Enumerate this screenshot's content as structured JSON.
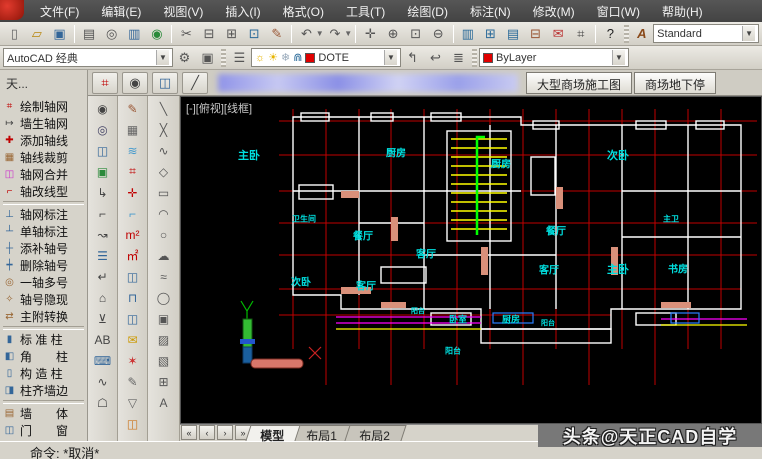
{
  "colors": {
    "canvas_bg": "#000000",
    "axis_red": "#c00000",
    "room_label_cyan": "#00e0e0",
    "stair_yellow": "#ffff00",
    "stair_green": "#00ff00",
    "balcony_magenta": "#ff00ff",
    "wall_white": "#ffffff",
    "layer_swatch_red": "#e00000"
  },
  "menu": {
    "items": [
      {
        "label": "文件(F)"
      },
      {
        "label": "编辑(E)"
      },
      {
        "label": "视图(V)"
      },
      {
        "label": "插入(I)"
      },
      {
        "label": "格式(O)"
      },
      {
        "label": "工具(T)"
      },
      {
        "label": "绘图(D)"
      },
      {
        "label": "标注(N)"
      },
      {
        "label": "修改(M)"
      },
      {
        "label": "窗口(W)"
      },
      {
        "label": "帮助(H)"
      }
    ]
  },
  "toolbar1": {
    "icons": [
      {
        "name": "new-file-icon",
        "glyph": "▯",
        "color": "#666"
      },
      {
        "name": "open-file-icon",
        "glyph": "▱",
        "color": "#b8860b"
      },
      {
        "name": "save-icon",
        "glyph": "▣",
        "color": "#336699"
      },
      {
        "sep": true
      },
      {
        "name": "print-icon",
        "glyph": "▤",
        "color": "#555"
      },
      {
        "name": "print-preview-icon",
        "glyph": "◎",
        "color": "#555"
      },
      {
        "name": "eplot-icon",
        "glyph": "▥",
        "color": "#336699"
      },
      {
        "name": "publish-icon",
        "glyph": "◉",
        "color": "#2a8a3a"
      },
      {
        "sep": true
      },
      {
        "name": "cut-icon",
        "glyph": "✂",
        "color": "#555"
      },
      {
        "name": "copy-icon",
        "glyph": "⊟",
        "color": "#555"
      },
      {
        "name": "paste-icon",
        "glyph": "⊞",
        "color": "#555"
      },
      {
        "name": "paste-as-block-icon",
        "glyph": "⊡",
        "color": "#2a6a99"
      },
      {
        "name": "match-properties-icon",
        "glyph": "✎",
        "color": "#995533"
      },
      {
        "sep": true
      },
      {
        "name": "undo-icon",
        "glyph": "↶",
        "color": "#555",
        "caret": true
      },
      {
        "name": "redo-icon",
        "glyph": "↷",
        "color": "#555",
        "caret": true
      },
      {
        "sep": true
      },
      {
        "name": "pan-icon",
        "glyph": "✛",
        "color": "#555"
      },
      {
        "name": "zoom-realtime-icon",
        "glyph": "⊕",
        "color": "#555"
      },
      {
        "name": "zoom-window-icon",
        "glyph": "⊡",
        "color": "#555"
      },
      {
        "name": "zoom-previous-icon",
        "glyph": "⊖",
        "color": "#555"
      },
      {
        "sep": true
      },
      {
        "name": "properties-icon",
        "glyph": "▥",
        "color": "#2a6a99"
      },
      {
        "name": "designcenter-icon",
        "glyph": "⊞",
        "color": "#2a6a99"
      },
      {
        "name": "tool-palettes-icon",
        "glyph": "▤",
        "color": "#2a6a99"
      },
      {
        "name": "sheetset-manager-icon",
        "glyph": "⊟",
        "color": "#995533"
      },
      {
        "name": "markup-set-icon",
        "glyph": "✉",
        "color": "#bb3333"
      },
      {
        "name": "quickcalc-icon",
        "glyph": "⌗",
        "color": "#444"
      },
      {
        "sep": true
      },
      {
        "name": "help-icon",
        "glyph": "?",
        "color": "#222"
      }
    ],
    "textstyle_icon_label": "A",
    "style_combo_value": "Standard"
  },
  "toolbar2": {
    "workspace_combo_value": "AutoCAD 经典",
    "gear_icon": "⚙",
    "workspace_settings_icon": "▣",
    "layer_properties_icon": "☰",
    "layer_combo": {
      "bulb_icon": "☼",
      "sun_icon": "☀",
      "freeze_icon": "❄",
      "lock_icon": "⋒",
      "layer_name": "DOTE"
    },
    "make_object_layer_icon": "↰",
    "layer_previous_icon": "↩",
    "layer_states_icon": "≣",
    "color_combo_value": "ByLayer"
  },
  "row3": {
    "palette_caption": "天...",
    "mini_toolbar": [
      {
        "name": "axis-grid-icon",
        "glyph": "⌗",
        "color": "#c00000"
      },
      {
        "name": "camera-icon",
        "glyph": "◉",
        "color": "#444"
      },
      {
        "name": "column-tool-icon",
        "glyph": "◫",
        "color": "#336699"
      },
      {
        "name": "draw-line-icon",
        "glyph": "╱",
        "color": "#444"
      }
    ],
    "doc_tabs": [
      {
        "label": "大型商场施工图"
      },
      {
        "label": "商场地下停"
      }
    ]
  },
  "sidebar": {
    "items": [
      {
        "label": "绘制轴网",
        "glyph": "⌗",
        "color": "#c00000"
      },
      {
        "label": "墙生轴网",
        "glyph": "↦",
        "color": "#444444"
      },
      {
        "label": "添加轴线",
        "glyph": "✚",
        "color": "#c00000"
      },
      {
        "label": "轴线裁剪",
        "glyph": "▦",
        "color": "#996633"
      },
      {
        "label": "轴网合并",
        "glyph": "◫",
        "color": "#cc33cc"
      },
      {
        "label": "轴改线型",
        "glyph": "⌐",
        "color": "#c00000"
      },
      {
        "label": "轴网标注",
        "glyph": "⊥",
        "color": "#336699",
        "sep_before": true
      },
      {
        "label": "单轴标注",
        "glyph": "┴",
        "color": "#336699"
      },
      {
        "label": "添补轴号",
        "glyph": "┼",
        "color": "#336699"
      },
      {
        "label": "删除轴号",
        "glyph": "┿",
        "color": "#336699"
      },
      {
        "label": "一轴多号",
        "glyph": "◎",
        "color": "#996633"
      },
      {
        "label": "轴号隐现",
        "glyph": "✧",
        "color": "#996633"
      },
      {
        "label": "主附转换",
        "glyph": "⇄",
        "color": "#996633"
      },
      {
        "label": "标 准 柱",
        "glyph": "▮",
        "color": "#336699",
        "sep_before": true
      },
      {
        "label": "角　　柱",
        "glyph": "◧",
        "color": "#336699"
      },
      {
        "label": "构 造 柱",
        "glyph": "▯",
        "color": "#336699"
      },
      {
        "label": "柱齐墙边",
        "glyph": "◨",
        "color": "#336699"
      },
      {
        "label": "墙　　体",
        "glyph": "▤",
        "color": "#996633",
        "sep_before": true
      },
      {
        "label": "门　　窗",
        "glyph": "◫",
        "color": "#336699"
      }
    ]
  },
  "toolcols": {
    "col1": [
      {
        "name": "camera-icon",
        "glyph": "◉",
        "color": "#444"
      },
      {
        "name": "zoom-doc-icon",
        "glyph": "◎",
        "color": "#446"
      },
      {
        "name": "window-pair-icon",
        "glyph": "◫",
        "color": "#336699"
      },
      {
        "name": "viewport-icon",
        "glyph": "▣",
        "color": "#2a8a3a"
      },
      {
        "name": "leader-icon",
        "glyph": "↳",
        "color": "#444"
      },
      {
        "name": "dim-style-icon",
        "glyph": "⌐",
        "color": "#444"
      },
      {
        "name": "ab-arrow-icon",
        "glyph": "↝",
        "color": "#444"
      },
      {
        "name": "schedule-icon",
        "glyph": "☰",
        "color": "#336699"
      },
      {
        "name": "redirect-icon",
        "glyph": "↵",
        "color": "#444"
      },
      {
        "name": "door-swing-icon",
        "glyph": "⌂",
        "color": "#444"
      },
      {
        "name": "level-mark-icon",
        "glyph": "⊻",
        "color": "#444"
      },
      {
        "name": "ab-text-icon",
        "glyph": "AB",
        "color": "#444"
      },
      {
        "name": "keyboard-icon",
        "glyph": "⌨",
        "color": "#336699"
      },
      {
        "name": "wave-line-icon",
        "glyph": "∿",
        "color": "#444"
      },
      {
        "name": "lamp-icon",
        "glyph": "☖",
        "color": "#444"
      }
    ],
    "col2": [
      {
        "name": "clip-pen-icon",
        "glyph": "✎",
        "color": "#995533"
      },
      {
        "name": "wall-stamp-icon",
        "glyph": "▦",
        "color": "#666"
      },
      {
        "name": "layers-icon",
        "glyph": "≋",
        "color": "#4499cc"
      },
      {
        "name": "axis-grid-icon",
        "glyph": "⌗",
        "color": "#c00000"
      },
      {
        "name": "axis-cross-icon",
        "glyph": "✛",
        "color": "#c00000"
      },
      {
        "name": "step-section-icon",
        "glyph": "⌐",
        "color": "#4499cc"
      },
      {
        "name": "area-m2-icon",
        "glyph": "m²",
        "color": "#c00000"
      },
      {
        "name": "area-m2-box-icon",
        "glyph": "㎡",
        "color": "#c00000"
      },
      {
        "name": "window-tool-icon",
        "glyph": "◫",
        "color": "#336699"
      },
      {
        "name": "door-tool-icon",
        "glyph": "⊓",
        "color": "#336699"
      },
      {
        "name": "window2-tool-icon",
        "glyph": "◫",
        "color": "#336699"
      },
      {
        "name": "mail-icon",
        "glyph": "✉",
        "color": "#cc9900"
      },
      {
        "name": "seal-icon",
        "glyph": "✶",
        "color": "#cc3333"
      },
      {
        "name": "pen-path-icon",
        "glyph": "✎",
        "color": "#666"
      },
      {
        "name": "book-icon",
        "glyph": "▽",
        "color": "#666"
      },
      {
        "name": "color-window-icon",
        "glyph": "◫",
        "color": "#cc7722"
      }
    ],
    "col3": [
      {
        "name": "line-icon",
        "glyph": "╲",
        "color": "#555"
      },
      {
        "name": "xline-icon",
        "glyph": "╳",
        "color": "#555"
      },
      {
        "name": "polyline-icon",
        "glyph": "∿",
        "color": "#555"
      },
      {
        "name": "polygon-icon",
        "glyph": "◇",
        "color": "#555"
      },
      {
        "name": "rectangle-icon",
        "glyph": "▭",
        "color": "#555"
      },
      {
        "name": "arc-icon",
        "glyph": "◠",
        "color": "#555"
      },
      {
        "name": "circle-icon",
        "glyph": "○",
        "color": "#555"
      },
      {
        "name": "revcloud-icon",
        "glyph": "☁",
        "color": "#555"
      },
      {
        "name": "spline-icon",
        "glyph": "≈",
        "color": "#555"
      },
      {
        "name": "ellipse-icon",
        "glyph": "◯",
        "color": "#555"
      },
      {
        "name": "insert-block-icon",
        "glyph": "▣",
        "color": "#555"
      },
      {
        "name": "hatch-icon",
        "glyph": "▨",
        "color": "#555"
      },
      {
        "name": "gradient-icon",
        "glyph": "▧",
        "color": "#555"
      },
      {
        "name": "table-icon",
        "glyph": "⊞",
        "color": "#555"
      },
      {
        "name": "text-icon",
        "glyph": "A",
        "color": "#555"
      }
    ]
  },
  "canvas": {
    "viewport_label": "[-][俯视][线框]",
    "rooms": [
      {
        "label": "主卧",
        "x": 68,
        "y": 58,
        "fs": 11
      },
      {
        "label": "厨房",
        "x": 215,
        "y": 55,
        "fs": 10
      },
      {
        "label": "厨房",
        "x": 320,
        "y": 66,
        "fs": 10
      },
      {
        "label": "次卧",
        "x": 437,
        "y": 58,
        "fs": 11
      },
      {
        "label": "卫生间",
        "x": 123,
        "y": 122,
        "fs": 8
      },
      {
        "label": "餐厅",
        "x": 182,
        "y": 138,
        "fs": 10
      },
      {
        "label": "客厅",
        "x": 245,
        "y": 156,
        "fs": 10
      },
      {
        "label": "餐厅",
        "x": 375,
        "y": 133,
        "fs": 10
      },
      {
        "label": "次卧",
        "x": 120,
        "y": 184,
        "fs": 10
      },
      {
        "label": "客厅",
        "x": 185,
        "y": 188,
        "fs": 10
      },
      {
        "label": "客厅",
        "x": 368,
        "y": 172,
        "fs": 10
      },
      {
        "label": "主卧",
        "x": 437,
        "y": 172,
        "fs": 11
      },
      {
        "label": "书房",
        "x": 497,
        "y": 171,
        "fs": 10
      },
      {
        "label": "主卫",
        "x": 490,
        "y": 122,
        "fs": 8
      },
      {
        "label": "卧室",
        "x": 277,
        "y": 222,
        "fs": 9
      },
      {
        "label": "厨房",
        "x": 330,
        "y": 222,
        "fs": 9
      },
      {
        "label": "阳台",
        "x": 237,
        "y": 214,
        "fs": 7
      },
      {
        "label": "阳台",
        "x": 272,
        "y": 254,
        "fs": 8
      },
      {
        "label": "阳台",
        "x": 367,
        "y": 226,
        "fs": 7
      }
    ]
  },
  "bottom": {
    "nav_icons": [
      "«",
      "‹",
      "›",
      "»"
    ],
    "layout_tabs": [
      {
        "label": "模型",
        "active": true
      },
      {
        "label": "布局1",
        "active": false
      },
      {
        "label": "布局2",
        "active": false
      }
    ],
    "command_text": "命令: *取消*"
  },
  "watermark": "头条@天正CAD自学"
}
